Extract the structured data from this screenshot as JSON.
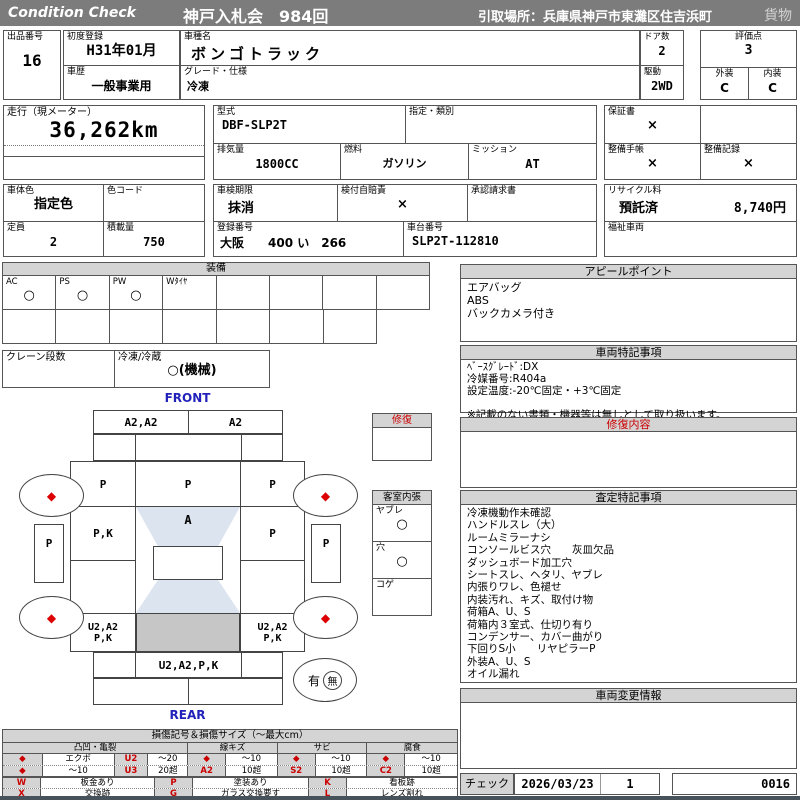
{
  "colors": {
    "title_bar_gray": "#7c7c7c",
    "section_header_gray": "#d4d4d4",
    "accent_red": "#cc0000",
    "front_rear_blue": "#2222bb",
    "glass_shade_blue": "#dce4f0",
    "floor_shade_gray": "#c6c6c6"
  },
  "header": {
    "brand": "Condition Check",
    "auction": "神戸入札会　984回",
    "pickup": "引取場所：兵庫県神戸市東灘区住吉浜町",
    "category": "貨物"
  },
  "info": {
    "lot_label": "出品番号",
    "lot_value": "16",
    "first_reg_label": "初度登録",
    "first_reg_value": "H31年01月",
    "history_label": "車歴",
    "history_value": "一般事業用",
    "model_label": "車種名",
    "model_value": "ボンゴトラック",
    "grade_label": "グレード・仕様",
    "grade_value": "冷凍",
    "doors_label": "ドア数",
    "doors_value": "2",
    "drive_label": "駆動",
    "drive_value": "2WD",
    "score_label": "評価点",
    "score_value": "3",
    "exterior_label": "外装",
    "exterior_value": "C",
    "interior_label": "内装",
    "interior_value": "C",
    "mileage_label": "走行（現メーター）",
    "mileage_value": "36,262km",
    "model_code_label": "型式",
    "model_code_value": "DBF-SLP2T",
    "designation_label": "指定・類別",
    "designation_value": "",
    "displacement_label": "排気量",
    "displacement_value": "1800CC",
    "fuel_label": "燃料",
    "fuel_value": "ガソリン",
    "transmission_label": "ミッション",
    "transmission_value": "AT",
    "warranty_label": "保証書",
    "warranty_value": "×",
    "service_book_label": "整備手帳",
    "service_book_value": "×",
    "service_record_label": "整備記録",
    "service_record_value": "×",
    "body_color_label": "車体色",
    "body_color_value": "指定色",
    "color_code_label": "色コード",
    "color_code_value": "",
    "inspection_label": "車検期限",
    "inspection_value": "抹消",
    "insurance_label": "検付自賠責",
    "insurance_value": "×",
    "approval_label": "承認請求書",
    "approval_value": "",
    "recycle_label": "リサイクル料",
    "recycle_status": "預託済",
    "recycle_fee": "8,740円",
    "capacity_label": "定員",
    "capacity_value": "2",
    "load_label": "積載量",
    "load_value": "750",
    "reg_number_label": "登録番号",
    "reg_number_value": "大阪　　400 い　266",
    "chassis_label": "車台番号",
    "chassis_value": "SLP2T-112810",
    "welfare_label": "福祉車両",
    "welfare_value": ""
  },
  "equipment": {
    "title": "装備",
    "items": [
      {
        "label": "AC",
        "value": "○"
      },
      {
        "label": "PS",
        "value": "○"
      },
      {
        "label": "PW",
        "value": "○"
      },
      {
        "label": "Wﾀｲﾔ",
        "value": ""
      },
      {
        "label": "",
        "value": ""
      },
      {
        "label": "",
        "value": ""
      },
      {
        "label": "",
        "value": ""
      },
      {
        "label": "",
        "value": ""
      }
    ],
    "crane_label": "クレーン段数",
    "crane_value": "",
    "reefer_label": "冷凍/冷蔵",
    "reefer_value": "○(機械)"
  },
  "appeal": {
    "title": "アピールポイント",
    "lines": [
      "エアバッグ",
      "ABS",
      "バックカメラ付き"
    ]
  },
  "special_notes": {
    "title": "車両特記事項",
    "lines": [
      "ﾍﾞｰｽｸﾞﾚｰﾄﾞ:DX",
      "冷媒番号:R404a",
      "設定温度:-20℃固定・+3℃固定",
      "",
      "※記載のない書類・機器等は無しとして取り扱います。"
    ]
  },
  "repair_content": {
    "title": "修復内容"
  },
  "assessment_notes": {
    "title": "査定特記事項",
    "lines": [
      "冷凍機動作未確認",
      "ハンドルスレ（大）",
      "ルームミラーナシ",
      "コンソールビス穴　　灰皿欠品",
      "ダッシュボード加工穴",
      "シートスレ、ヘタリ、ヤブレ",
      "内張りワレ、色褪せ",
      "内装汚れ、キズ、取付け物",
      "荷箱A、U、S",
      "荷箱内３室式、仕切り有り",
      "コンデンサー、カバー曲がり",
      "下回りS小　　リヤピラーP",
      "外装A、U、S",
      "オイル漏れ"
    ]
  },
  "change_info": {
    "title": "車両変更情報"
  },
  "diagram": {
    "front_label": "FRONT",
    "rear_label": "REAR",
    "front_panel_left": "A2,A2",
    "front_panel_right": "A2",
    "roof_left": "P",
    "roof_center": "P",
    "roof_right": "P",
    "door_left": "P,K",
    "windshield_center": "A",
    "door_right": "P",
    "mirror_left": "P",
    "mirror_right": "P",
    "cargo_left_line1": "U2,A2",
    "cargo_left_line2": "P,K",
    "cargo_right_line1": "U2,A2",
    "cargo_right_line2": "P,K",
    "rear_panel": "U2,A2,P,K",
    "wheel_mark": "◆",
    "presence_yes": "有",
    "presence_no": "無",
    "repair_box_title": "修復",
    "cabin": {
      "title": "客室内張",
      "items": [
        {
          "label": "ヤブレ",
          "value": "○"
        },
        {
          "label": "穴",
          "value": "○"
        },
        {
          "label": "コゲ",
          "value": ""
        }
      ]
    }
  },
  "legend": {
    "title": "損傷記号＆損傷サイズ（～最大cm）",
    "groups": [
      "凸凹・亀裂",
      "線キズ",
      "サビ",
      "腐食"
    ],
    "rows": [
      {
        "c1": "◆",
        "c2": "エクボ",
        "c3": "U2",
        "c4": "～20",
        "c5": "◆",
        "c6": "～10",
        "c7": "◆",
        "c8": "～10",
        "c9": "◆",
        "c10": "～10"
      },
      {
        "c1": "◆",
        "c2": "～10",
        "c3": "U3",
        "c4": "20超",
        "c5": "A2",
        "c6": "10超",
        "c7": "S2",
        "c8": "10超",
        "c9": "C2",
        "c10": "10超"
      }
    ],
    "codes": [
      {
        "code": "W",
        "label": "板金あり"
      },
      {
        "code": "P",
        "label": "塗装あり"
      },
      {
        "code": "K",
        "label": "看板跡"
      },
      {
        "code": "X",
        "label": "交換跡"
      },
      {
        "code": "G",
        "label": "ガラス交換要す"
      },
      {
        "code": "L",
        "label": "レンズ割れ"
      }
    ]
  },
  "check": {
    "label": "チェック",
    "date": "2026/03/23",
    "count": "1",
    "number": "0016"
  }
}
